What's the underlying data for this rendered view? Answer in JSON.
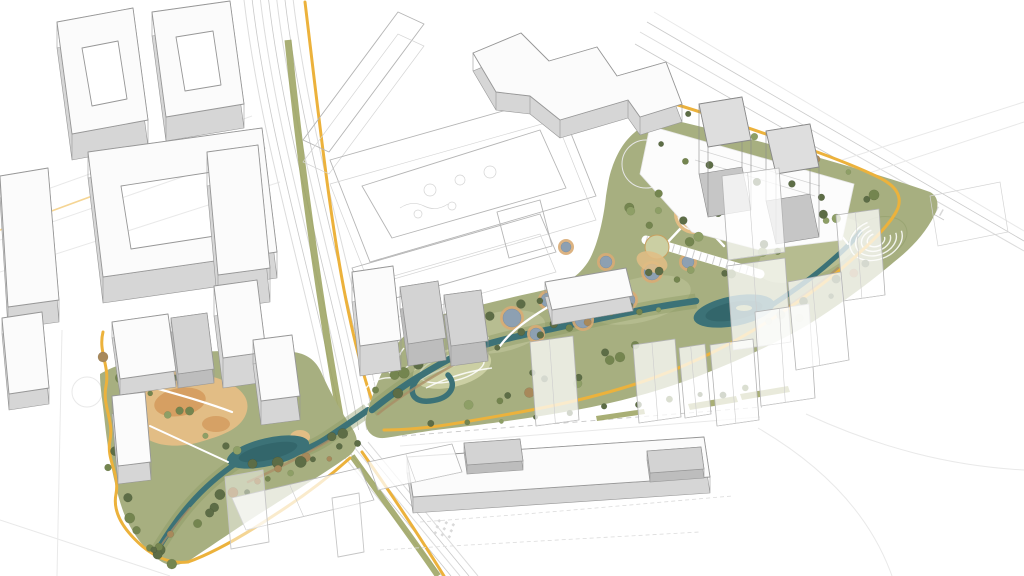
{
  "scene": {
    "type": "axonometric-masterplan-rendering",
    "description": "Urban masterplan bird's-eye rendering: white context blocks and wireframe blocks around a linear riverside park with translucent proposed towers, ponds, play plazas and a yellow pedestrian loop",
    "elements": [
      "context-buildings",
      "wireframe-blocks",
      "proposed-ghost-towers",
      "linear-park",
      "meandering-river",
      "lake",
      "ponds",
      "play-plazas",
      "yellow-loop-path",
      "tree-lined-boulevard",
      "amphitheater-lawn",
      "long-low-rise-slab",
      "twin-gray-towers"
    ]
  },
  "palette": {
    "paper": "#ffffff",
    "line": "#dcdcdc",
    "line2": "#c9c9c9",
    "wire": "#b5b5b5",
    "bldg_top": "#fbfbfb",
    "bldg_face": "#d6d6d6",
    "bldg_edge": "#979797",
    "gray_top": "#d3d3d3",
    "gray_face": "#bdbdbd",
    "tower_top": "#dedede",
    "tower_face": "#c6c6c6",
    "ghost_fill": "rgba(255,255,255,0.74)",
    "ghost_edge": "#b3b3b3",
    "park": "#a7af80",
    "park_dark": "#86955f",
    "park_light": "#c2c79c",
    "lawn": "#cbcfa3",
    "sand": "#e2bd85",
    "sand_deep": "#d39a5c",
    "plaza": "#cd9051",
    "tree1": "#5d6d46",
    "tree2": "#74854f",
    "tree3": "#8e9f66",
    "tree4": "#a8895b",
    "river": "#3c7277",
    "river_deep": "#2b5c62",
    "pond": "#8da0b2",
    "pond_rim": "#d8ab74",
    "yellow": "#ecb23c",
    "yellow_deep": "#df9e2c",
    "olive": "#9aa15d",
    "bank": "#ab8d66",
    "white_path": "#ffffff"
  }
}
